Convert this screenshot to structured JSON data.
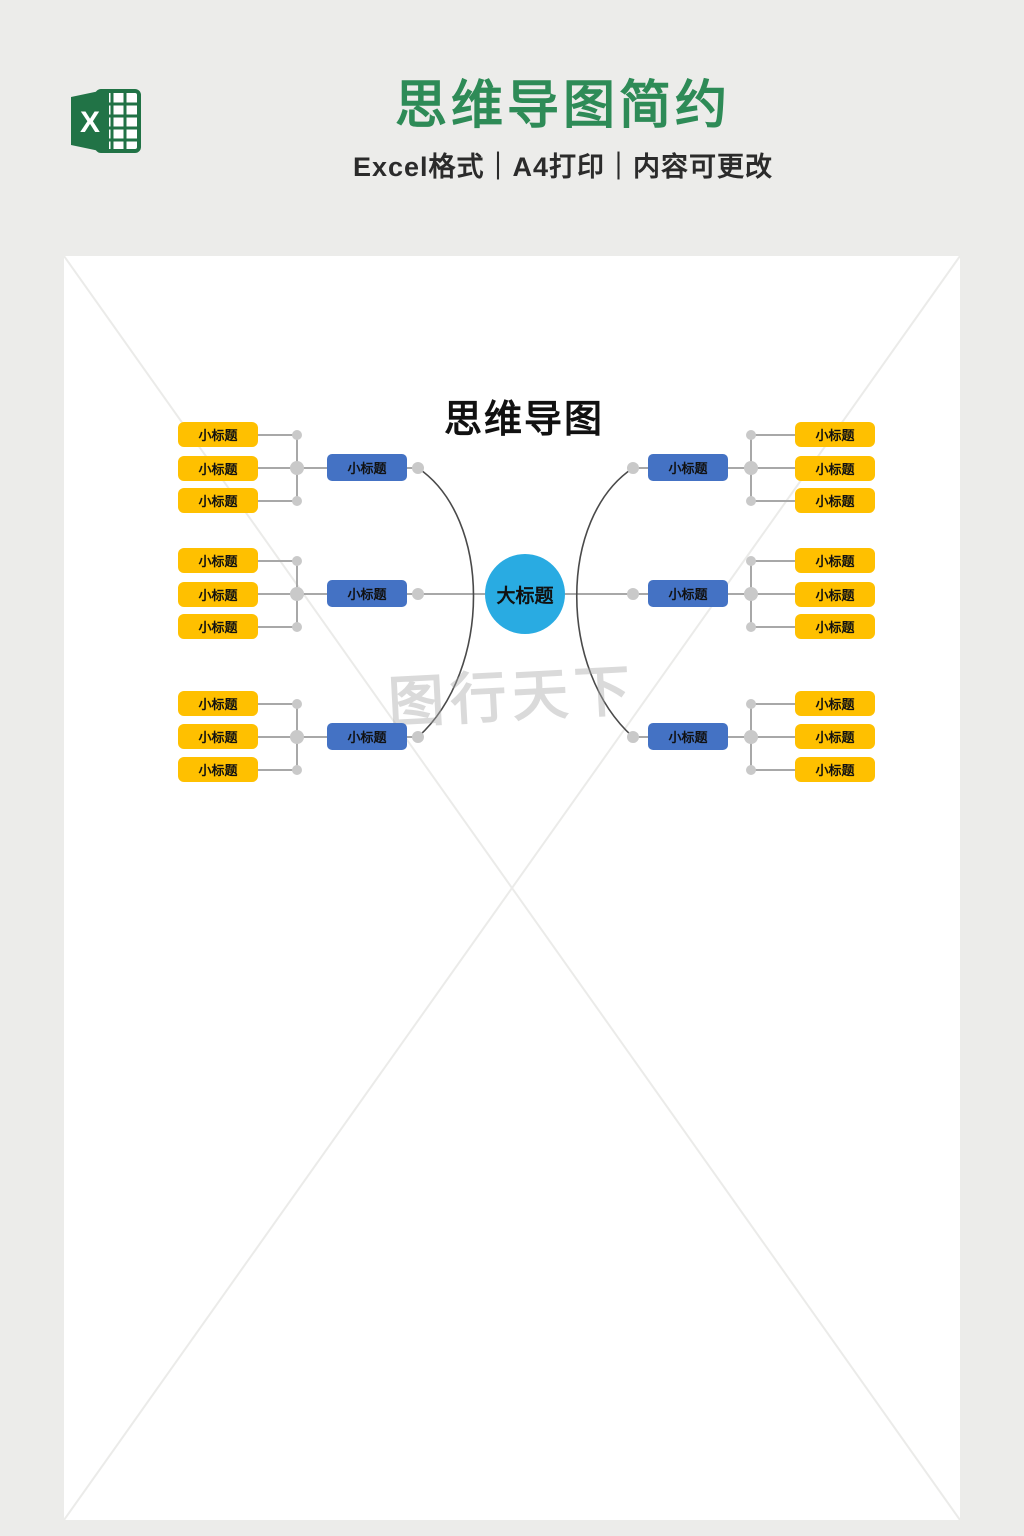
{
  "banner": {
    "icon": {
      "name": "excel-icon",
      "letter": "X"
    },
    "title": "思维导图简约",
    "subtitle": "Excel格式｜A4打印｜内容可更改"
  },
  "mindmap": {
    "title": "思维导图",
    "center": {
      "label": "大标题"
    },
    "left_branches": [
      {
        "label": "小标题",
        "children": [
          "小标题",
          "小标题",
          "小标题"
        ]
      },
      {
        "label": "小标题",
        "children": [
          "小标题",
          "小标题",
          "小标题"
        ]
      },
      {
        "label": "小标题",
        "children": [
          "小标题",
          "小标题",
          "小标题"
        ]
      }
    ],
    "right_branches": [
      {
        "label": "小标题",
        "children": [
          "小标题",
          "小标题",
          "小标题"
        ]
      },
      {
        "label": "小标题",
        "children": [
          "小标题",
          "小标题",
          "小标题"
        ]
      },
      {
        "label": "小标题",
        "children": [
          "小标题",
          "小标题",
          "小标题"
        ]
      }
    ],
    "watermark": "图行天下"
  },
  "colors": {
    "header_title": "#2e8b57",
    "excel_green": "#217346",
    "center_node": "#29abe2",
    "branch_node": "#4472c4",
    "leaf_node": "#ffc000",
    "connector": "#a8a8a8",
    "curve": "#4a4a4a",
    "dot": "#c9c9c9",
    "background": "#ececea",
    "page": "#ffffff",
    "watermark": "#a8a8a8"
  }
}
